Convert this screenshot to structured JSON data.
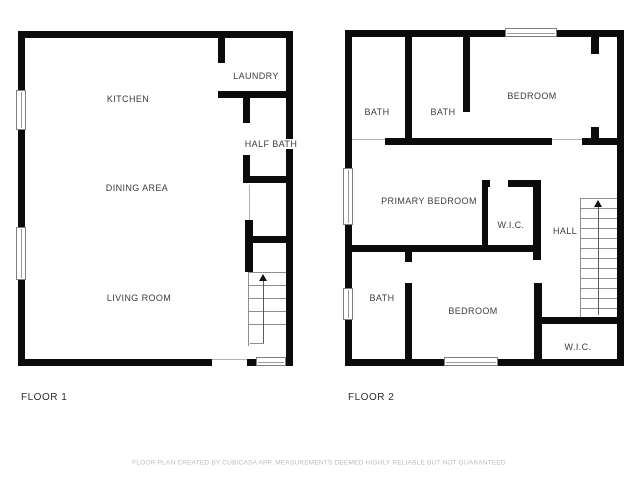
{
  "floor1": {
    "label": "FLOOR 1",
    "rooms": {
      "kitchen": "KITCHEN",
      "dining": "DINING AREA",
      "living": "LIVING ROOM",
      "laundry": "LAUNDRY",
      "half_bath": "HALF BATH"
    }
  },
  "floor2": {
    "label": "FLOOR 2",
    "rooms": {
      "bath1": "BATH",
      "bath2": "BATH",
      "bedroom1": "BEDROOM",
      "primary_bedroom": "PRIMARY BEDROOM",
      "wic1": "W.I.C.",
      "hall": "HALL",
      "bath3": "BATH",
      "bedroom2": "BEDROOM",
      "wic2": "W.I.C."
    }
  },
  "footer": {
    "disclaimer": "FLOOR PLAN CREATED BY CUBICASA APP. MEASUREMENTS DEEMED HIGHLY RELIABLE BUT NOT GUARANTEED."
  },
  "colors": {
    "wall": "#0b0b0b",
    "background": "#ffffff",
    "label_text": "#3d3d3d",
    "stair_line": "#8f8f8f",
    "watermark_text": "#bdbdbd"
  }
}
